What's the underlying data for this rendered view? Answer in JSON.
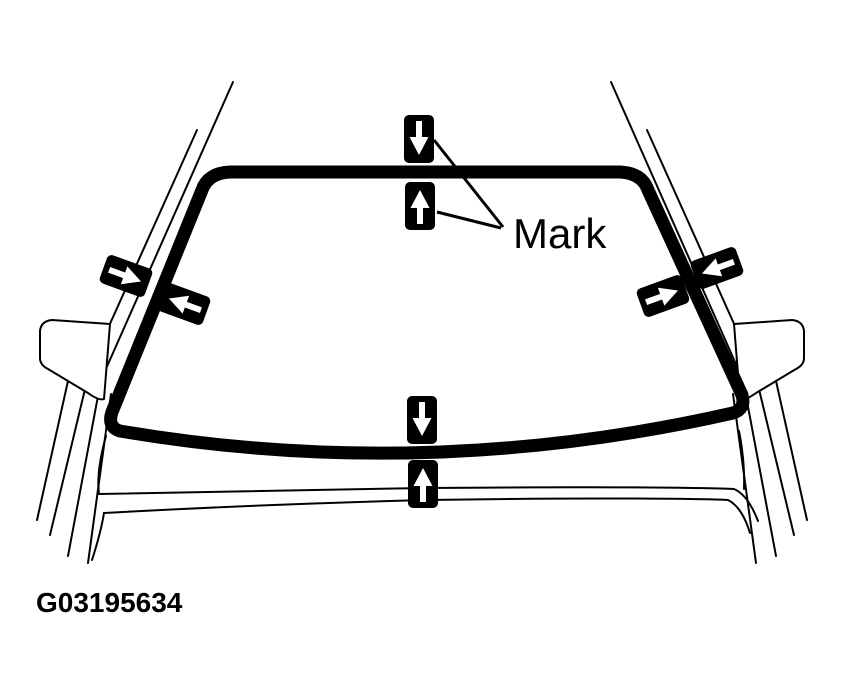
{
  "figure": {
    "label": "Mark",
    "figure_id": "G03195634"
  },
  "colors": {
    "ink": "#000000",
    "background": "#ffffff",
    "marker_box": "#000000",
    "marker_arrow": "#ffffff"
  },
  "markers": [
    {
      "position": "top-outer",
      "icon": "arrow-down-icon"
    },
    {
      "position": "top-inner",
      "icon": "arrow-up-icon"
    },
    {
      "position": "left-outer",
      "icon": "arrow-right-icon"
    },
    {
      "position": "left-inner",
      "icon": "arrow-left-icon"
    },
    {
      "position": "right-outer",
      "icon": "arrow-left-icon"
    },
    {
      "position": "right-inner",
      "icon": "arrow-right-icon"
    },
    {
      "position": "bottom-outer",
      "icon": "arrow-down-icon"
    },
    {
      "position": "bottom-inner",
      "icon": "arrow-up-icon"
    }
  ]
}
